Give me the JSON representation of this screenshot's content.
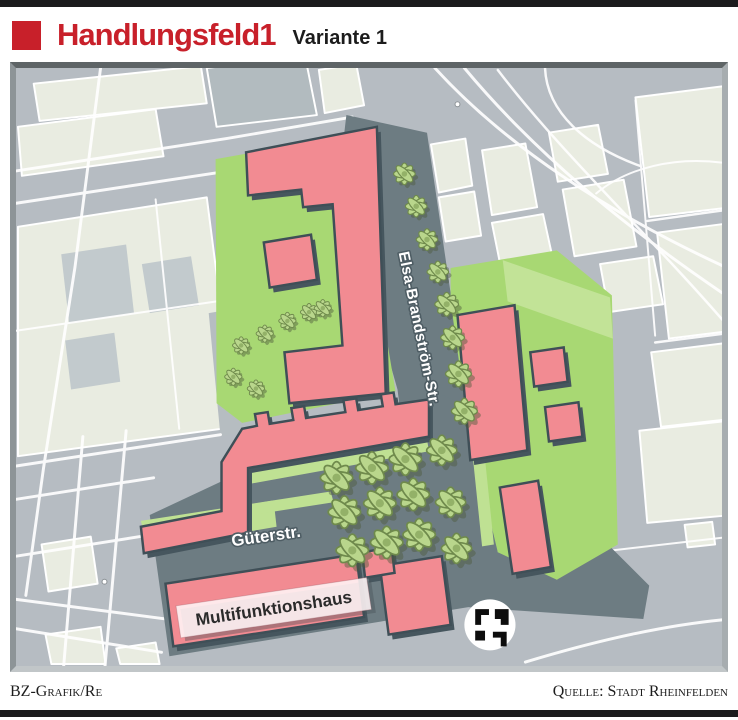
{
  "header": {
    "kicker": "Handlungsfeld1",
    "variant": "Variante 1"
  },
  "map": {
    "street_labels": {
      "elsa_brandstroem": "Elsa-Brandström-Str.",
      "gueterstrasse": "Güterstr."
    },
    "building_labels": {
      "multifunktionshaus": "Multifunktionshaus"
    },
    "logo": "stadt-rheinfelden-logo",
    "colors": {
      "accent_red": "#c8202a",
      "planned_building": "#f28b92",
      "green_space": "#a8d873",
      "light_green": "#c2e397",
      "planned_street": "#6d7c82",
      "existing_block": "#e9ece1",
      "base_road": "#b6bcc2"
    }
  },
  "footer": {
    "credit": "BZ-Grafik/Re",
    "source": "Quelle: Stadt Rheinfelden"
  }
}
